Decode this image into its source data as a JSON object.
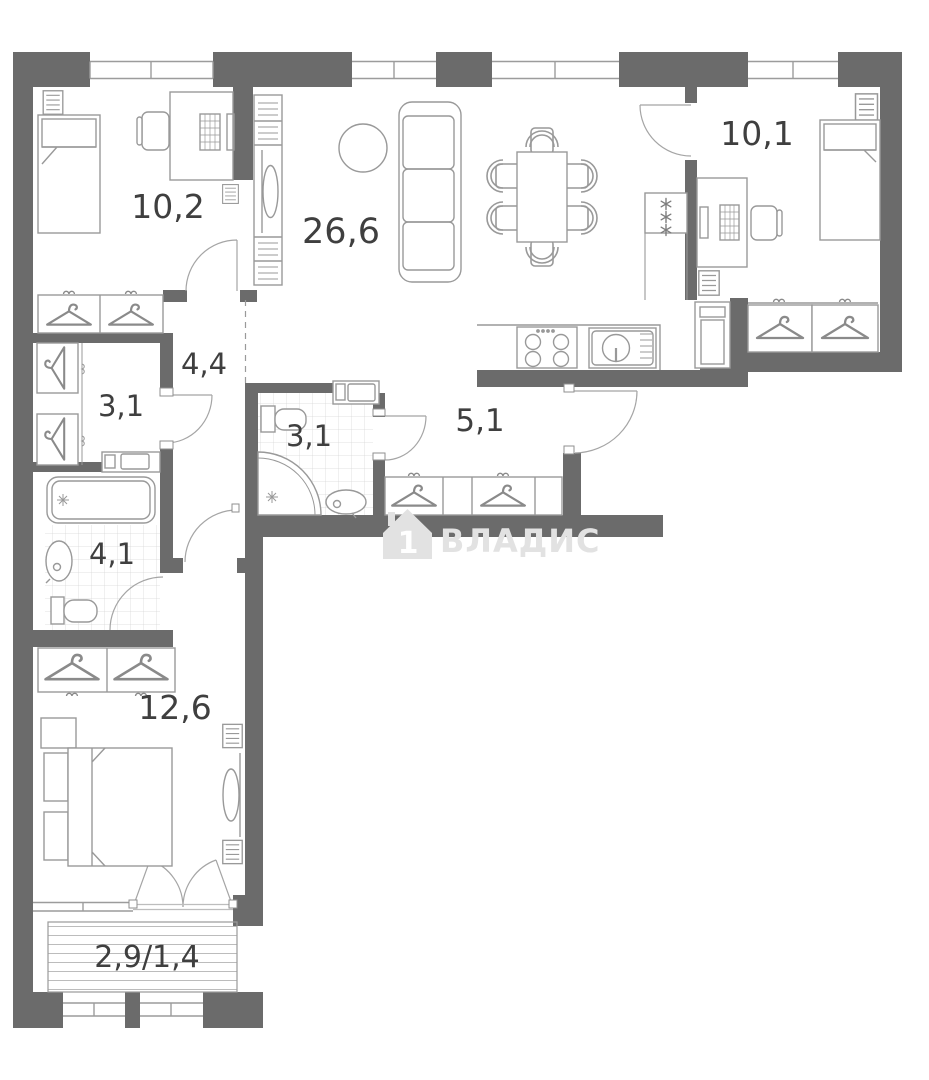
{
  "plan_type": "apartment-floor-plan",
  "rooms": [
    {
      "id": "bedroom-top-left",
      "area": "10,2"
    },
    {
      "id": "living-room-kitchen",
      "area": "26,6"
    },
    {
      "id": "bedroom-top-right",
      "area": "10,1"
    },
    {
      "id": "hallway",
      "area": "4,4"
    },
    {
      "id": "wardrobe-closet",
      "area": "3,1"
    },
    {
      "id": "bathroom-middle",
      "area": "3,1"
    },
    {
      "id": "corridor",
      "area": "5,1"
    },
    {
      "id": "bathroom-left",
      "area": "4,1"
    },
    {
      "id": "bedroom-bottom",
      "area": "12,6"
    },
    {
      "id": "balcony",
      "area": "2,9/1,4"
    }
  ],
  "watermark": {
    "brand": "ВЛАДИС",
    "icon": "house-1-icon",
    "icon_text": "1"
  },
  "colors": {
    "wall": "#6b6b6b",
    "furniture_line": "#999999",
    "tile_line": "#d8d8d8",
    "window_line": "#9c9c9c",
    "label_text": "#3f3f3f",
    "watermark": "#e2e2e2",
    "background": "#ffffff"
  }
}
